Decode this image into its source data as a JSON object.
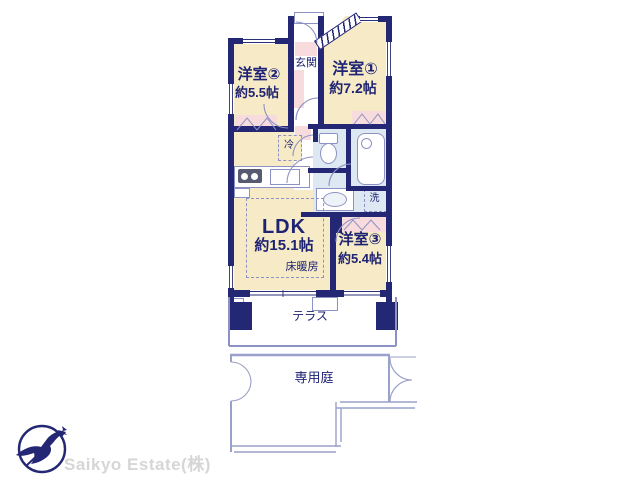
{
  "colors": {
    "wall": "#232774",
    "cream": "#f7eac6",
    "pink": "#f8dbdd",
    "blue": "#dde8f2",
    "line": "#8d92c4",
    "garden": "#9aa0c9",
    "text": "#1e2373",
    "logo_gray": "#d6d6d6",
    "stove": "#565b72"
  },
  "rooms": {
    "bedroom2": {
      "name": "洋室②",
      "size": "約5.5帖"
    },
    "bedroom1": {
      "name": "洋室①",
      "size": "約7.2帖"
    },
    "bedroom3": {
      "name": "洋室③",
      "size": "約5.4帖"
    },
    "ldk": {
      "name": "LDK",
      "size": "約15.1帖",
      "floor_heating": "床暖房"
    },
    "entrance": {
      "name": "玄関"
    },
    "terrace": {
      "name": "テラス"
    },
    "garden": {
      "name": "専用庭"
    }
  },
  "fixtures": {
    "refrigerator": "冷",
    "laundry": "洗"
  },
  "logo": {
    "company": "Saikyo Estate(株)"
  }
}
